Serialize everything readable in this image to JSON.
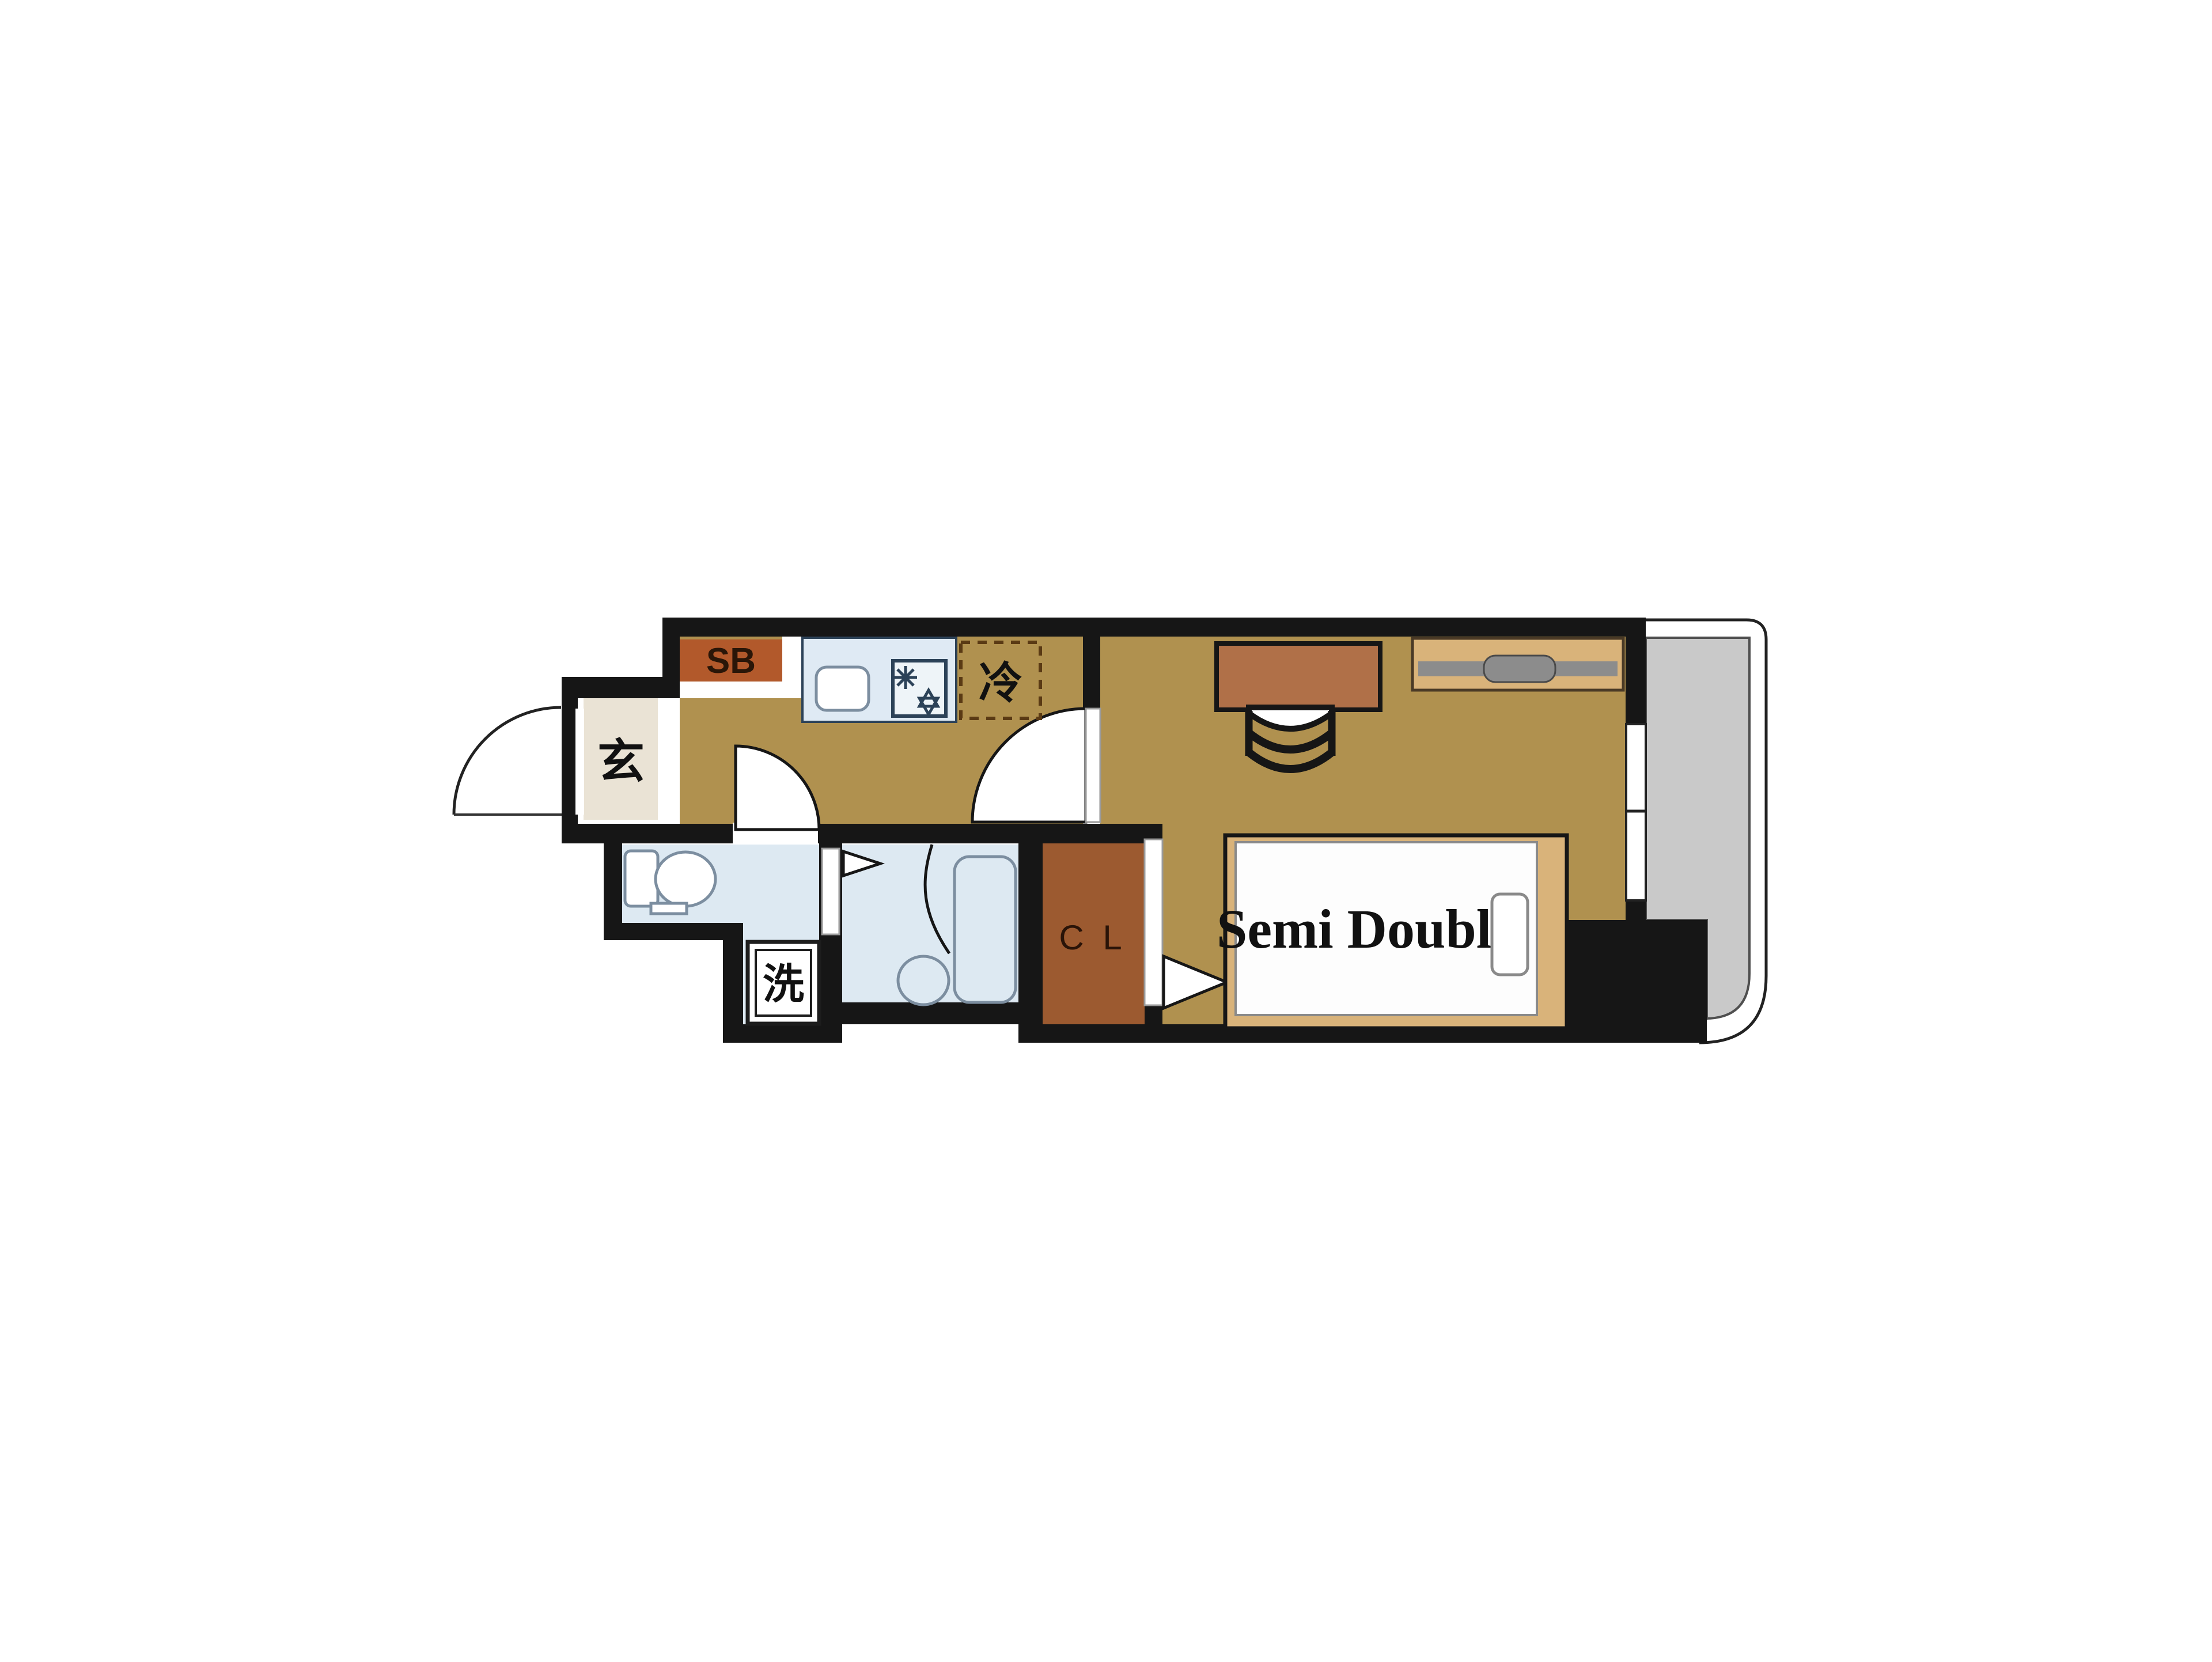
{
  "title": "One-room apartment floor plan",
  "labels": {
    "shoe_box": "SB",
    "entrance": "玄",
    "refrigerator": "冷",
    "washer": "洗",
    "closet": "C L",
    "bed": "Semi Double"
  },
  "colors": {
    "wall": "#161616",
    "floor": "#b0914f",
    "genkan": "#eae3d5",
    "wet": "#dde9f2",
    "counter": "#dfeaf4",
    "fixture": "#7c8ea0",
    "stove": "#2c4258",
    "closet": "#9c5a30",
    "shoebox": "#b2592b",
    "wood": "#b07048",
    "bedframe": "#d9b37a",
    "balcony": "#c9c9c9",
    "balcony_border": "#4f4f4f",
    "gray_bar": "#8c8c8c",
    "outline": "#222222",
    "label_dark": "#2a1608",
    "text": "#111111"
  }
}
